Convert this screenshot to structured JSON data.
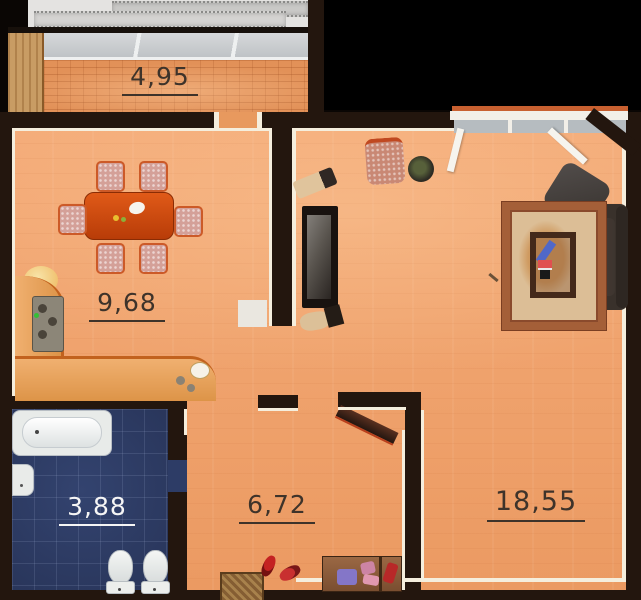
{
  "rooms": {
    "balcony": {
      "area": "4,95"
    },
    "kitchen_dining": {
      "area": "9,68"
    },
    "bathroom": {
      "area": "3,88"
    },
    "hallway": {
      "area": "6,72"
    },
    "living_room": {
      "area": "18,55"
    }
  },
  "colors": {
    "floor_orange": "#efa06c",
    "balcony_brick": "#e29158",
    "bathroom_tile": "#2d3c66",
    "wall": "#23160e",
    "trim": "#f5eedd",
    "background": "#0a0604",
    "dining_table": "#ce4c10",
    "sofa": "#39312b",
    "rug_border": "#ad6742",
    "rug_field": "#dcbe96",
    "label_dark": "#3e332a",
    "label_light": "#f5f5f5"
  }
}
